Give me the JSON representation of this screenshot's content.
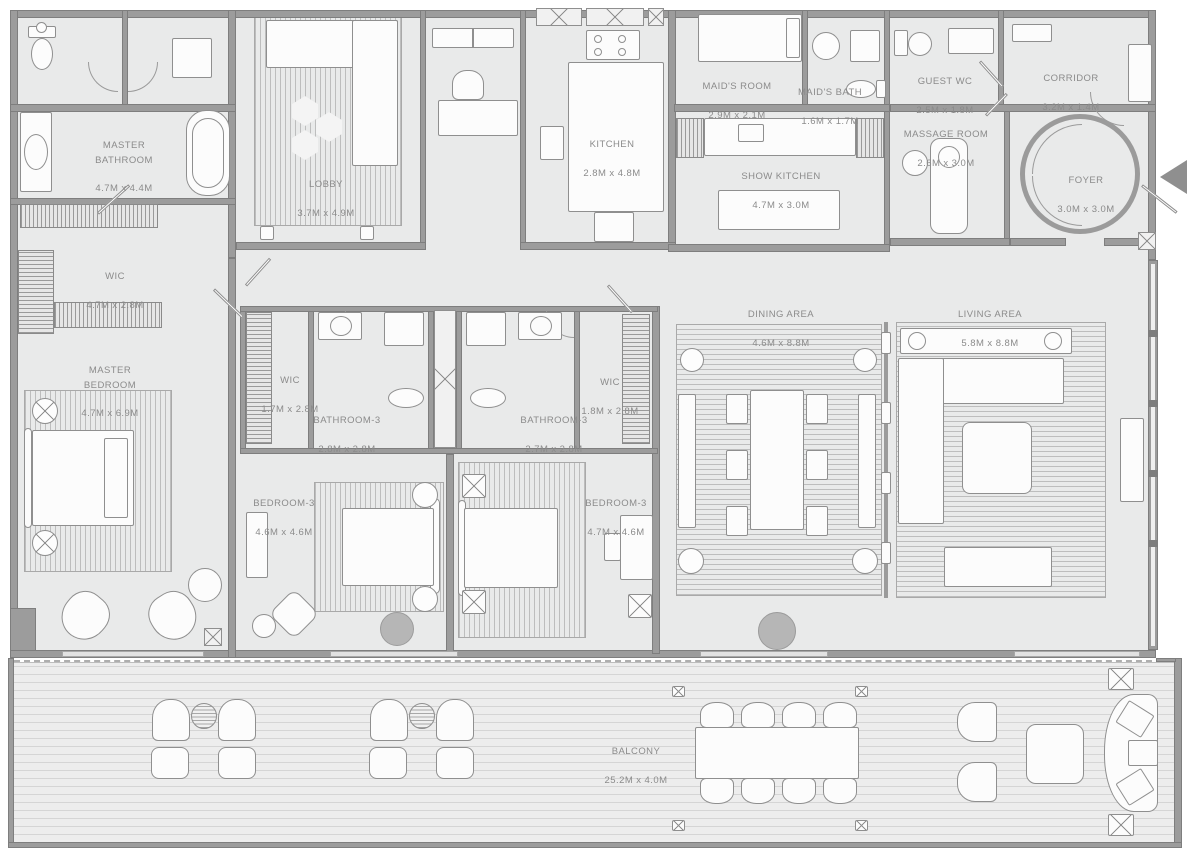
{
  "plan_title": "3-bedroom penthouse floor plan",
  "colors": {
    "wall": "#9c9c9c",
    "wall_edge": "#7e7e7e",
    "floor": "#e9eaea",
    "furniture_fill": "#fcfcfc",
    "furniture_line": "#8f8f8f",
    "label_text": "#8b8b8b",
    "column_fill": "#b6b6b6",
    "entry_arrow": "#8f8f8f"
  },
  "entry": {
    "icon": "left-arrow",
    "meaning": "entrance"
  },
  "rooms": [
    {
      "id": "master-bathroom",
      "name": "MASTER\nBATHROOM",
      "dims": "4.7M x 4.4M"
    },
    {
      "id": "lobby",
      "name": "LOBBY",
      "dims": "3.7M x 4.9M"
    },
    {
      "id": "kitchen",
      "name": "KITCHEN",
      "dims": "2.8M x 4.8M"
    },
    {
      "id": "maids-room",
      "name": "MAID'S ROOM",
      "dims": "2.9M x 2.1M"
    },
    {
      "id": "maids-bath",
      "name": "MAID'S BATH",
      "dims": "1.6M x 1.7M"
    },
    {
      "id": "guest-wc",
      "name": "GUEST WC",
      "dims": "2.5M x 1.8M"
    },
    {
      "id": "corridor",
      "name": "CORRIDOR",
      "dims": "3.2M x 1.4M"
    },
    {
      "id": "show-kitchen",
      "name": "SHOW KITCHEN",
      "dims": "4.7M x 3.0M"
    },
    {
      "id": "massage-room",
      "name": "MASSAGE ROOM",
      "dims": "2.6M x 3.0M"
    },
    {
      "id": "foyer",
      "name": "FOYER",
      "dims": "3.0M x 3.0M"
    },
    {
      "id": "wic-master",
      "name": "WIC",
      "dims": "4.7M x 2.8M"
    },
    {
      "id": "master-bedroom",
      "name": "MASTER\nBEDROOM",
      "dims": "4.7M x 6.9M"
    },
    {
      "id": "wic-2",
      "name": "WIC",
      "dims": "1.7M x 2.8M"
    },
    {
      "id": "bathroom-3a",
      "name": "BATHROOM-3",
      "dims": "2.8M x 2.8M"
    },
    {
      "id": "bathroom-3b",
      "name": "BATHROOM-3",
      "dims": "2.7M x 2.8M"
    },
    {
      "id": "wic-3",
      "name": "WIC",
      "dims": "1.8M x 2.8M"
    },
    {
      "id": "bedroom-3a",
      "name": "BEDROOM-3",
      "dims": "4.6M x 4.6M"
    },
    {
      "id": "bedroom-3b",
      "name": "BEDROOM-3",
      "dims": "4.7M x 4.6M"
    },
    {
      "id": "dining-area",
      "name": "DINING AREA",
      "dims": "4.6M x 8.8M"
    },
    {
      "id": "living-area",
      "name": "LIVING AREA",
      "dims": "5.8M x 8.8M"
    },
    {
      "id": "balcony",
      "name": "BALCONY",
      "dims": "25.2M x 4.0M"
    }
  ]
}
